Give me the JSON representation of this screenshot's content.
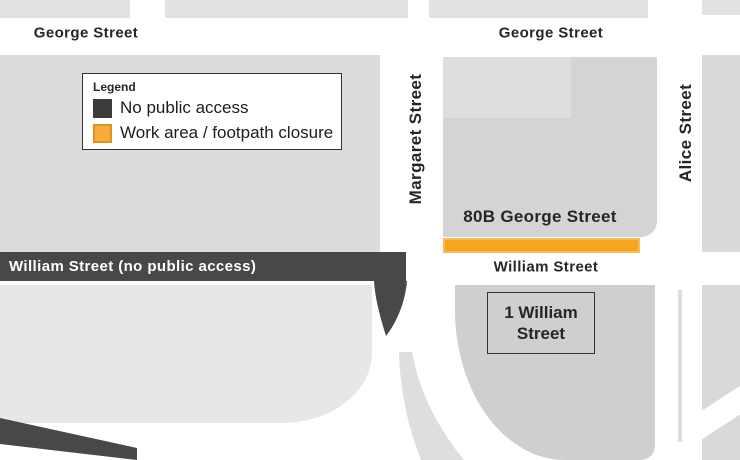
{
  "map": {
    "streets": {
      "george_left": "George Street",
      "george_right": "George Street",
      "margaret": "Margaret Street",
      "alice": "Alice Street",
      "william": "William Street",
      "william_no_access": "William Street (no public access)"
    },
    "buildings": {
      "b80": "80B George Street",
      "w1": "1 William Street"
    },
    "legend": {
      "title": "Legend",
      "items": [
        {
          "label": "No public access",
          "color": "#3b3b3b"
        },
        {
          "label": "Work area / footpath closure",
          "color": "#F8AC3B",
          "border": "#E0921F"
        }
      ]
    },
    "colors": {
      "no_access_road": "#484848",
      "work_area_fill": "#F7A51F",
      "work_area_border": "#F3BE62"
    }
  }
}
